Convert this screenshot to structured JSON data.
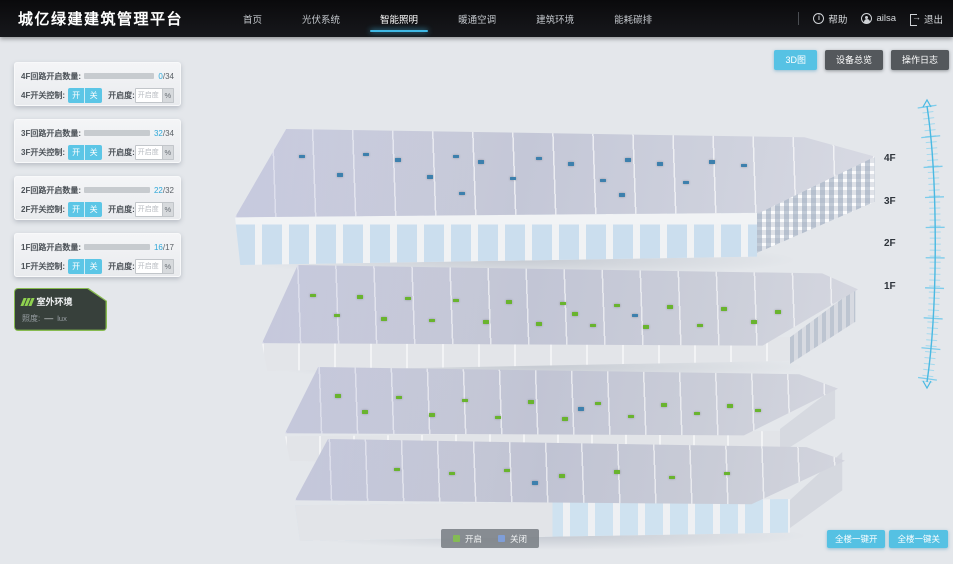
{
  "header": {
    "title": "城亿绿建建筑管理平台",
    "nav_items": [
      "首页",
      "光伏系统",
      "智能照明",
      "暖通空调",
      "建筑环境",
      "能耗碳排"
    ],
    "help_label": "帮助",
    "user_name": "ailsa",
    "logout_label": "退出"
  },
  "toolbar": {
    "view_3d": "3D图",
    "device_overview": "设备总览",
    "operation_log": "操作日志"
  },
  "panels": [
    {
      "circuit_label": "4F回路开启数量:",
      "open_count": "0",
      "total": "/34",
      "pct": 0,
      "switch_label": "4F开关控制:",
      "on_label": "开",
      "off_label": "关",
      "dim_label": "开启度:",
      "dim_placeholder": "开启度",
      "percent_label": "%"
    },
    {
      "circuit_label": "3F回路开启数量:",
      "open_count": "32",
      "total": "/34",
      "pct": 94,
      "switch_label": "3F开关控制:",
      "on_label": "开",
      "off_label": "关",
      "dim_label": "开启度:",
      "dim_placeholder": "开启度",
      "percent_label": "%"
    },
    {
      "circuit_label": "2F回路开启数量:",
      "open_count": "22",
      "total": "/32",
      "pct": 69,
      "switch_label": "2F开关控制:",
      "on_label": "开",
      "off_label": "关",
      "dim_label": "开启度:",
      "dim_placeholder": "开启度",
      "percent_label": "%"
    },
    {
      "circuit_label": "1F回路开启数量:",
      "open_count": "16",
      "total": "/17",
      "pct": 94,
      "switch_label": "1F开关控制:",
      "on_label": "开",
      "off_label": "关",
      "dim_label": "开启度:",
      "dim_placeholder": "开启度",
      "percent_label": "%"
    }
  ],
  "outdoor": {
    "title": "室外环境",
    "illuminance_label": "照度:",
    "illuminance_value": "—",
    "illuminance_unit": "lux"
  },
  "floor_markers": [
    "4F",
    "3F",
    "2F",
    "1F"
  ],
  "legend": {
    "on_label": "开启",
    "off_label": "关闭",
    "on_color": "#84bb54",
    "off_color": "#7f9ed8"
  },
  "bottom_actions": {
    "all_on": "全楼一键开",
    "all_off": "全楼一键关"
  },
  "building": {
    "on_dot_color": "#69b42e",
    "off_dot_color": "#3d80ad",
    "floors": [
      {
        "name": "4F",
        "dots_on": [],
        "dots_off": [
          [
            10,
            28
          ],
          [
            16,
            48
          ],
          [
            20,
            26
          ],
          [
            25,
            32
          ],
          [
            30,
            50
          ],
          [
            34,
            28
          ],
          [
            38,
            34
          ],
          [
            43,
            52
          ],
          [
            47,
            30
          ],
          [
            52,
            36
          ],
          [
            57,
            54
          ],
          [
            61,
            32
          ],
          [
            66,
            36
          ],
          [
            70,
            56
          ],
          [
            74,
            34
          ],
          [
            79,
            38
          ],
          [
            60,
            70
          ],
          [
            35,
            68
          ]
        ]
      },
      {
        "name": "3F",
        "dots_on": [
          [
            8,
            34
          ],
          [
            12,
            58
          ],
          [
            16,
            36
          ],
          [
            20,
            62
          ],
          [
            24,
            38
          ],
          [
            28,
            64
          ],
          [
            32,
            40
          ],
          [
            37,
            66
          ],
          [
            41,
            42
          ],
          [
            46,
            68
          ],
          [
            50,
            44
          ],
          [
            55,
            70
          ],
          [
            59,
            46
          ],
          [
            64,
            72
          ],
          [
            68,
            48
          ],
          [
            73,
            70
          ],
          [
            77,
            50
          ],
          [
            82,
            66
          ],
          [
            86,
            54
          ],
          [
            52,
            56
          ]
        ],
        "dots_off": [
          [
            62,
            58
          ]
        ]
      },
      {
        "name": "2F",
        "dots_on": [
          [
            9,
            38
          ],
          [
            14,
            60
          ],
          [
            20,
            40
          ],
          [
            26,
            64
          ],
          [
            32,
            44
          ],
          [
            38,
            68
          ],
          [
            44,
            46
          ],
          [
            50,
            70
          ],
          [
            56,
            48
          ],
          [
            62,
            66
          ],
          [
            68,
            50
          ],
          [
            74,
            62
          ],
          [
            80,
            52
          ],
          [
            85,
            58
          ]
        ],
        "dots_off": [
          [
            53,
            56
          ]
        ]
      },
      {
        "name": "1F",
        "dots_on": [
          [
            18,
            42
          ],
          [
            28,
            48
          ],
          [
            38,
            44
          ],
          [
            48,
            52
          ],
          [
            58,
            46
          ],
          [
            68,
            54
          ],
          [
            78,
            48
          ]
        ],
        "dots_off": [
          [
            43,
            62
          ]
        ]
      }
    ]
  }
}
